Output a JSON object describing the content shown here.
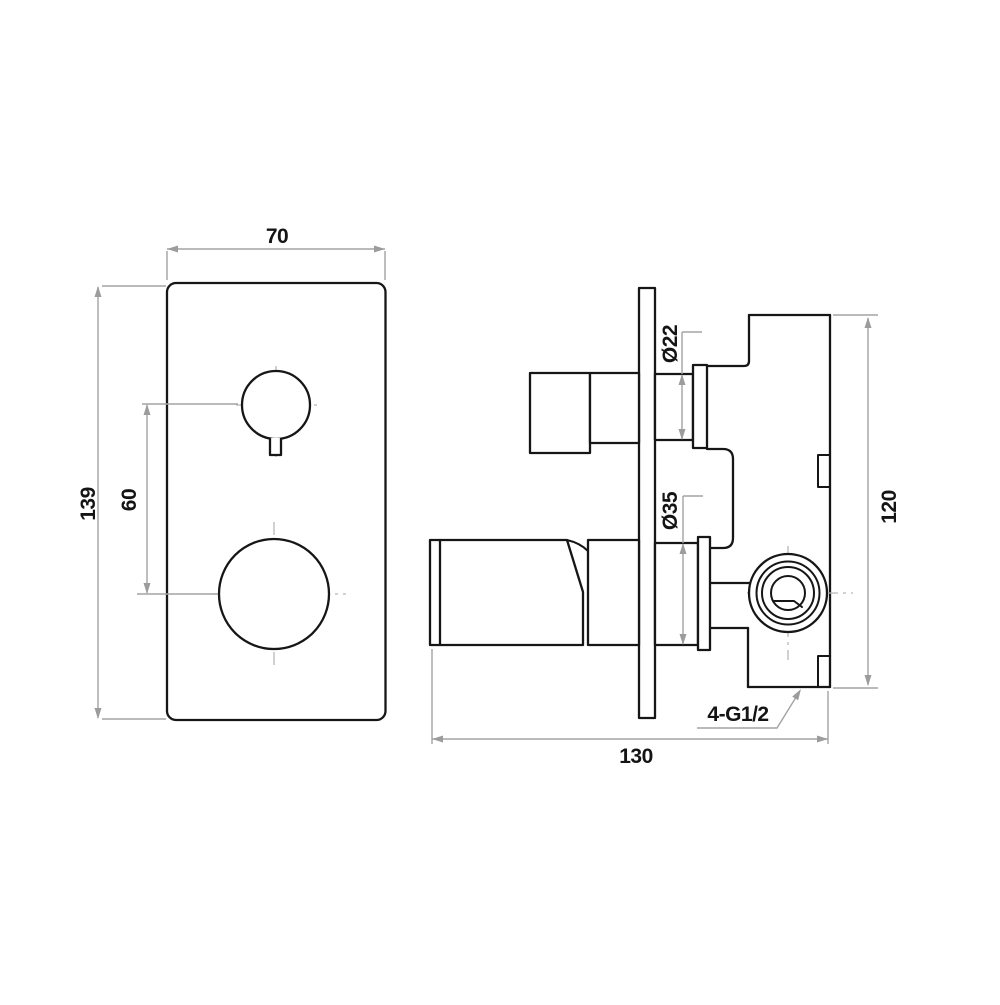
{
  "drawing": {
    "front_view": {
      "plate_width": "70",
      "plate_height": "139",
      "handle_spacing": "60"
    },
    "side_view": {
      "upper_stem_diameter": "Ø22",
      "lower_stem_diameter": "Ø35",
      "body_height": "120",
      "overall_depth": "130",
      "thread_spec": "4-G1/2"
    },
    "colors": {
      "outline": "#161616",
      "dimension_line": "#a3a3a3",
      "centerline": "#b8b8b8",
      "background": "#ffffff"
    }
  }
}
